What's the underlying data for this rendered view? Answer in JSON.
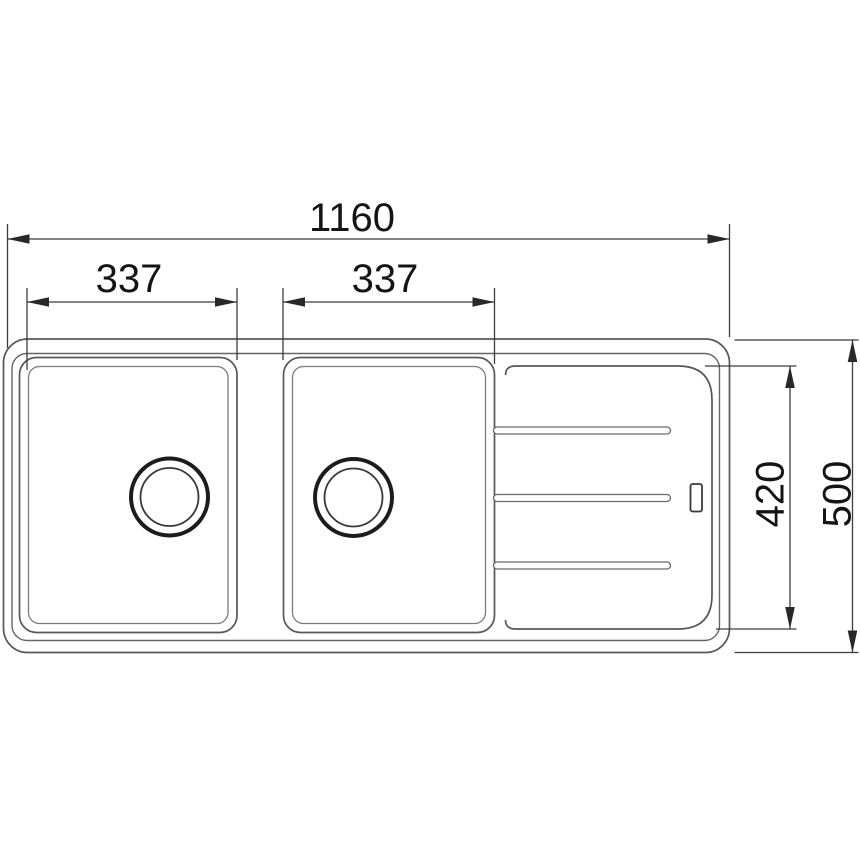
{
  "drawing": {
    "kind": "technical-dimension-drawing",
    "subject": "double-bowl-sink-with-drainer-top-view",
    "units_implied": "mm",
    "colors": {
      "background": "#ffffff",
      "sink_outline": "#57575a",
      "dimension_lines": "#3c3c3e",
      "dimension_text": "#141414",
      "drain_ring": "#1c1c1c"
    }
  },
  "dimensions": {
    "overall_width": {
      "value": "1160"
    },
    "left_bowl_width": {
      "value": "337"
    },
    "right_bowl_width": {
      "value": "337"
    },
    "inner_depth": {
      "value": "420"
    },
    "overall_depth": {
      "value": "500"
    }
  }
}
